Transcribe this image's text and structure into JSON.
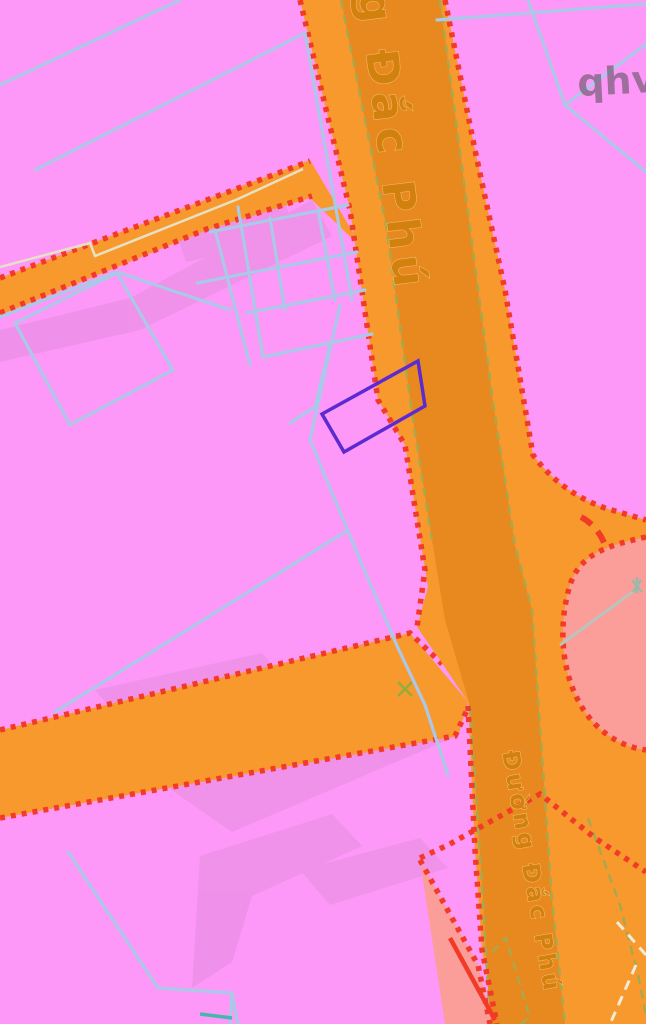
{
  "map": {
    "kind": "zoning-cadastral-map",
    "street_labels": {
      "upper": "Đường Đắc Phú",
      "lower": "Đường Đắc Phú"
    },
    "corner_text": "qhv",
    "selected_parcel": {
      "points": "418,361 425,406 344,452 322,414",
      "outline": "#5b2bd0"
    },
    "colors": {
      "zone_pink": "#fd98f8",
      "zone_orange": "#f8992e",
      "road_core": "#e8891f",
      "zone_salmon": "#fb9d98",
      "boundary_red": "#f23a28",
      "parcel_line_blue": "#abc8e8",
      "lot_line_olive": "#a9a84c",
      "lot_line_cream": "#f2ecd4",
      "pale_road_line": "#e6e0c4",
      "label_orange": "#d2810f",
      "corner_text_color": "#645564",
      "watermark_pink": "#d583cf",
      "teal_mark": "#46b6ae"
    }
  }
}
